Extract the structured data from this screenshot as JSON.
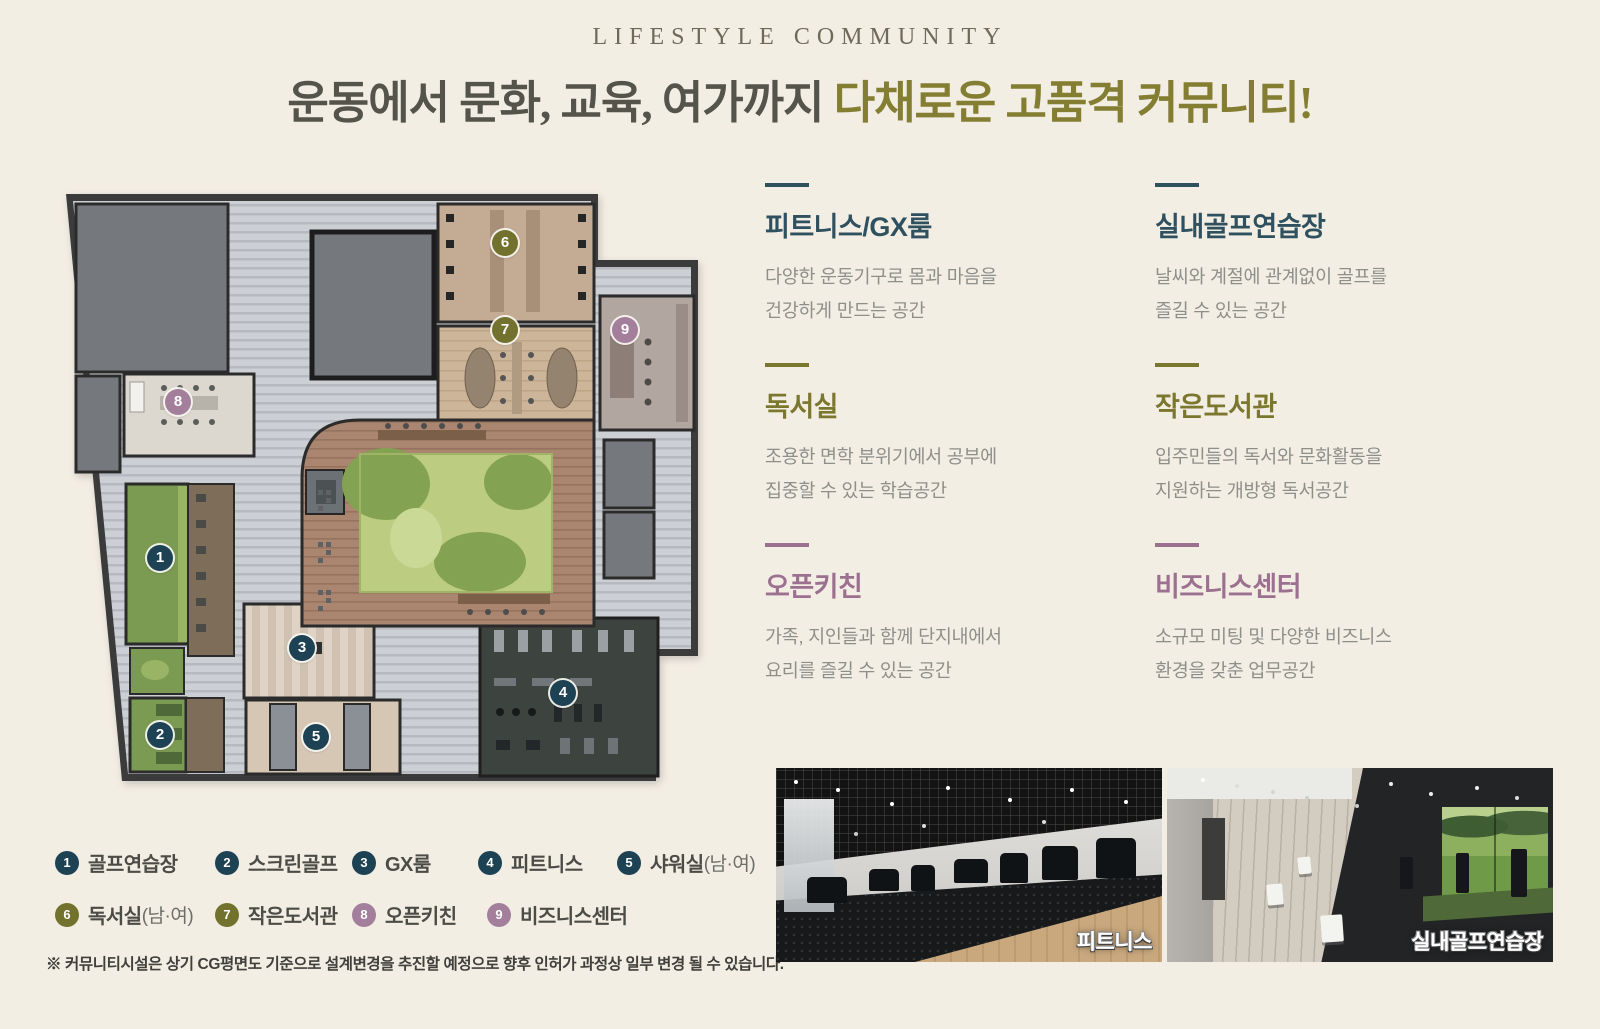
{
  "header": {
    "eyebrow": "LIFESTYLE COMMUNITY",
    "title_plain": "운동에서 문화, 교육, 여가까지 ",
    "title_accent": "다채로운 고품격 커뮤니티!"
  },
  "features": [
    {
      "title": "피트니스/GX룸",
      "line1": "다양한 운동기구로 몸과 마음을",
      "line2": "건강하게 만드는 공간",
      "accent_color": "#2f505e"
    },
    {
      "title": "실내골프연습장",
      "line1": "날씨와 계절에 관계없이 골프를",
      "line2": "즐길 수 있는 공간",
      "accent_color": "#2f505e"
    },
    {
      "title": "독서실",
      "line1": "조용한 면학 분위기에서 공부에",
      "line2": "집중할 수 있는 학습공간",
      "accent_color": "#7b772e"
    },
    {
      "title": "작은도서관",
      "line1": "입주민들의 독서와 문화활동을",
      "line2": "지원하는 개방형 독서공간",
      "accent_color": "#7b772e"
    },
    {
      "title": "오픈키친",
      "line1": "가족, 지인들과 함께 단지내에서",
      "line2": "요리를 즐길 수 있는 공간",
      "accent_color": "#9c7190"
    },
    {
      "title": "비즈니스센터",
      "line1": "소규모 미팅 및 다양한 비즈니스",
      "line2": "환경을 갖춘 업무공간",
      "accent_color": "#9c7190"
    }
  ],
  "plan": {
    "markers": [
      {
        "number": "1"
      },
      {
        "number": "2"
      },
      {
        "number": "3"
      },
      {
        "number": "4"
      },
      {
        "number": "5"
      },
      {
        "number": "6"
      },
      {
        "number": "7"
      },
      {
        "number": "8"
      },
      {
        "number": "9"
      }
    ]
  },
  "legend": {
    "items": [
      {
        "number": "1",
        "label": "골프연습장",
        "suffix": ""
      },
      {
        "number": "2",
        "label": "스크린골프",
        "suffix": ""
      },
      {
        "number": "3",
        "label": "GX룸",
        "suffix": ""
      },
      {
        "number": "4",
        "label": "피트니스",
        "suffix": ""
      },
      {
        "number": "5",
        "label": "샤워실",
        "suffix": "(남·여)"
      },
      {
        "number": "6",
        "label": "독서실",
        "suffix": "(남·여)"
      },
      {
        "number": "7",
        "label": "작은도서관",
        "suffix": ""
      },
      {
        "number": "8",
        "label": "오픈키친",
        "suffix": ""
      },
      {
        "number": "9",
        "label": "비즈니스센터",
        "suffix": ""
      }
    ]
  },
  "photos": [
    {
      "caption": "피트니스"
    },
    {
      "caption": "실내골프연습장"
    }
  ],
  "footnote": "※ 커뮤니티시설은 상기 CG평면도 기준으로 설계변경을 추진할 예정으로 향후 인허가 과정상 일부 변경 될 수 있습니다.",
  "colors": {
    "background": "#f3eee4",
    "title_accent": "#847e33",
    "accent_teal": "#2f505e",
    "accent_olive": "#7b772e",
    "accent_mauve": "#9c7190",
    "marker_teal": "#1d4254",
    "marker_olive": "#72712e",
    "marker_mauve": "#a47f9c"
  }
}
